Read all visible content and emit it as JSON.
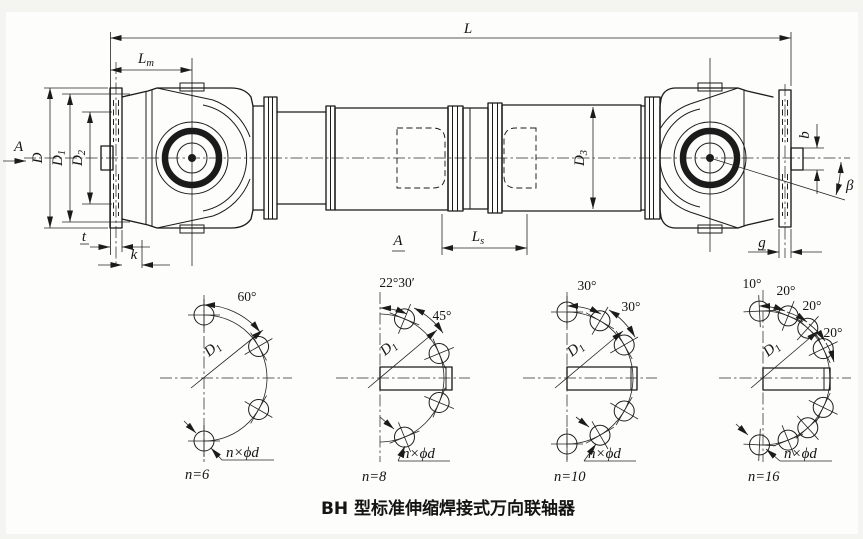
{
  "caption": "BH 型标准伸缩焊接式万向联轴器",
  "view_labels": {
    "section_arrow": "A",
    "section_mark": "A"
  },
  "dims": {
    "L": "L",
    "Lm": {
      "base": "L",
      "sub": "m"
    },
    "D": "D",
    "D1": {
      "base": "D",
      "sub": "1"
    },
    "D2": {
      "base": "D",
      "sub": "2"
    },
    "D3": {
      "base": "D",
      "sub": "3"
    },
    "Ls": {
      "base": "L",
      "sub": "s"
    },
    "b": "b",
    "beta": "β",
    "t": "t",
    "k": "k",
    "g": "g"
  },
  "bolt_circles": [
    {
      "n_label": "n=6",
      "angles": [
        "60°"
      ],
      "d1": {
        "base": "D",
        "sub": "1"
      },
      "holes_label": "n×ϕd"
    },
    {
      "n_label": "n=8",
      "angles": [
        "22°30′",
        "45°"
      ],
      "d1": {
        "base": "D",
        "sub": "1"
      },
      "holes_label": "n×ϕd"
    },
    {
      "n_label": "n=10",
      "angles": [
        "30°",
        "30°"
      ],
      "d1": {
        "base": "D",
        "sub": "1"
      },
      "holes_label": "n×ϕd"
    },
    {
      "n_label": "n=16",
      "angles": [
        "10°",
        "20°",
        "20°",
        "20°"
      ],
      "d1": {
        "base": "D",
        "sub": "1"
      },
      "holes_label": "n×ϕd"
    }
  ],
  "colors": {
    "ink": "#1b1b1b",
    "paper": "#fbfbf8"
  }
}
